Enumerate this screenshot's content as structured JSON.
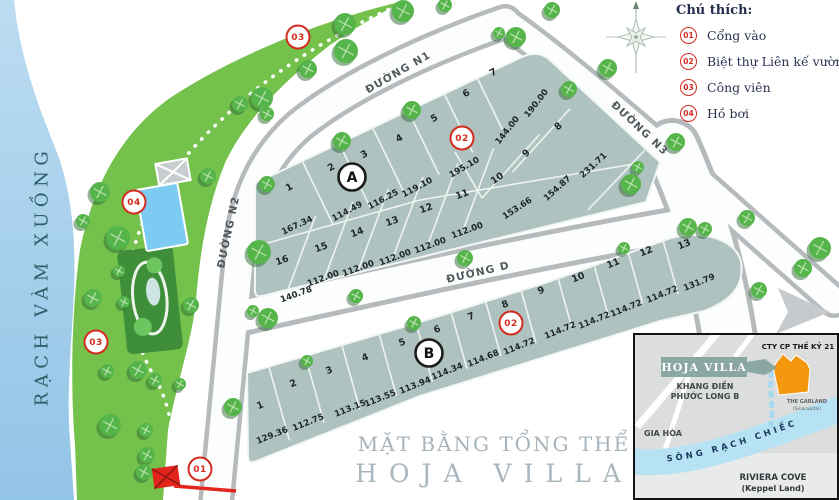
{
  "title": {
    "line1": "MẶT BẰNG TỔNG THỂ",
    "line2": "HOJA VILLA"
  },
  "legend": {
    "heading": "Chú thích:",
    "items": [
      {
        "num": "01",
        "label": "Cổng vào"
      },
      {
        "num": "02",
        "label": "Biệt thự Liên kế vườn"
      },
      {
        "num": "03",
        "label": "Công viên"
      },
      {
        "num": "04",
        "label": "Hồ bơi"
      }
    ]
  },
  "river_label": "RẠCH VÀM XUỒNG",
  "roads": [
    {
      "name": "ĐƯỜNG N1"
    },
    {
      "name": "ĐƯỜNG N2"
    },
    {
      "name": "ĐƯỜNG N3"
    },
    {
      "name": "ĐƯỜNG D"
    }
  ],
  "blocks": [
    {
      "name": "A",
      "marker": {
        "x": 352,
        "y": 177
      },
      "lots": [
        {
          "n": "1",
          "x": 289,
          "y": 187,
          "a": -29
        },
        {
          "n": "2",
          "x": 331,
          "y": 167,
          "a": -29
        },
        {
          "n": "3",
          "x": 364,
          "y": 154,
          "a": -29
        },
        {
          "n": "4",
          "x": 399,
          "y": 138,
          "a": -29
        },
        {
          "n": "5",
          "x": 434,
          "y": 118,
          "a": -29
        },
        {
          "n": "6",
          "x": 466,
          "y": 93,
          "a": -29
        },
        {
          "n": "7",
          "x": 493,
          "y": 72,
          "a": -29
        },
        {
          "n": "8",
          "x": 558,
          "y": 126,
          "a": -42
        },
        {
          "n": "9",
          "x": 526,
          "y": 153,
          "a": -42
        },
        {
          "n": "10",
          "x": 497,
          "y": 178,
          "a": -35
        },
        {
          "n": "11",
          "x": 462,
          "y": 194,
          "a": -20
        },
        {
          "n": "12",
          "x": 426,
          "y": 208,
          "a": -20
        },
        {
          "n": "13",
          "x": 392,
          "y": 221,
          "a": -20
        },
        {
          "n": "14",
          "x": 357,
          "y": 232,
          "a": -20
        },
        {
          "n": "15",
          "x": 321,
          "y": 247,
          "a": -20
        },
        {
          "n": "16",
          "x": 282,
          "y": 260,
          "a": -20
        }
      ],
      "dims": [
        {
          "v": "167.34",
          "x": 297,
          "y": 225,
          "a": -25
        },
        {
          "v": "114.49",
          "x": 347,
          "y": 211,
          "a": -28
        },
        {
          "v": "116.25",
          "x": 383,
          "y": 199,
          "a": -28
        },
        {
          "v": "119.10",
          "x": 417,
          "y": 187,
          "a": -28
        },
        {
          "v": "195.10",
          "x": 464,
          "y": 167,
          "a": -30
        },
        {
          "v": "144.00",
          "x": 507,
          "y": 130,
          "a": -52
        },
        {
          "v": "190.00",
          "x": 536,
          "y": 103,
          "a": -52
        },
        {
          "v": "231.71",
          "x": 593,
          "y": 165,
          "a": -42
        },
        {
          "v": "154.87",
          "x": 557,
          "y": 188,
          "a": -42
        },
        {
          "v": "153.66",
          "x": 517,
          "y": 208,
          "a": -33
        },
        {
          "v": "112.00",
          "x": 467,
          "y": 230,
          "a": -20
        },
        {
          "v": "112.00",
          "x": 430,
          "y": 245,
          "a": -20
        },
        {
          "v": "112.00",
          "x": 395,
          "y": 257,
          "a": -20
        },
        {
          "v": "112.00",
          "x": 358,
          "y": 268,
          "a": -20
        },
        {
          "v": "112.00",
          "x": 323,
          "y": 278,
          "a": -20
        },
        {
          "v": "140.78",
          "x": 296,
          "y": 294,
          "a": -20
        }
      ]
    },
    {
      "name": "B",
      "marker": {
        "x": 429,
        "y": 353
      },
      "lots": [
        {
          "n": "1",
          "x": 260,
          "y": 405,
          "a": -22
        },
        {
          "n": "2",
          "x": 293,
          "y": 383,
          "a": -22
        },
        {
          "n": "3",
          "x": 329,
          "y": 370,
          "a": -22
        },
        {
          "n": "4",
          "x": 365,
          "y": 357,
          "a": -22
        },
        {
          "n": "5",
          "x": 402,
          "y": 342,
          "a": -22
        },
        {
          "n": "6",
          "x": 437,
          "y": 329,
          "a": -22
        },
        {
          "n": "7",
          "x": 471,
          "y": 316,
          "a": -22
        },
        {
          "n": "8",
          "x": 505,
          "y": 304,
          "a": -22
        },
        {
          "n": "9",
          "x": 541,
          "y": 290,
          "a": -22
        },
        {
          "n": "10",
          "x": 578,
          "y": 277,
          "a": -22
        },
        {
          "n": "11",
          "x": 613,
          "y": 263,
          "a": -22
        },
        {
          "n": "12",
          "x": 646,
          "y": 251,
          "a": -22
        },
        {
          "n": "13",
          "x": 684,
          "y": 244,
          "a": -22
        }
      ],
      "dims": [
        {
          "v": "129.36",
          "x": 272,
          "y": 435,
          "a": -22
        },
        {
          "v": "112.75",
          "x": 308,
          "y": 422,
          "a": -22
        },
        {
          "v": "113.15",
          "x": 350,
          "y": 408,
          "a": -22
        },
        {
          "v": "113.55",
          "x": 380,
          "y": 398,
          "a": -22
        },
        {
          "v": "113.94",
          "x": 415,
          "y": 385,
          "a": -22
        },
        {
          "v": "114.34",
          "x": 447,
          "y": 371,
          "a": -22
        },
        {
          "v": "114.68",
          "x": 483,
          "y": 358,
          "a": -22
        },
        {
          "v": "114.72",
          "x": 519,
          "y": 346,
          "a": -22
        },
        {
          "v": "114.72",
          "x": 560,
          "y": 330,
          "a": -22
        },
        {
          "v": "114.72",
          "x": 594,
          "y": 320,
          "a": -22
        },
        {
          "v": "114.72",
          "x": 626,
          "y": 308,
          "a": -22
        },
        {
          "v": "114.72",
          "x": 662,
          "y": 294,
          "a": -22
        },
        {
          "v": "131.79",
          "x": 699,
          "y": 282,
          "a": -22
        }
      ]
    }
  ],
  "poi_markers": [
    {
      "n": "03",
      "x": 298,
      "y": 37
    },
    {
      "n": "04",
      "x": 134,
      "y": 202
    },
    {
      "n": "03",
      "x": 96,
      "y": 342
    },
    {
      "n": "01",
      "x": 200,
      "y": 469
    },
    {
      "n": "02",
      "x": 462,
      "y": 138
    },
    {
      "n": "02",
      "x": 511,
      "y": 323
    }
  ],
  "inset": {
    "labels": {
      "company": "CTY CP THẾ KỶ 21",
      "project": "HOJA VILLA",
      "area1": "KHANG ĐIỀN",
      "area2": "PHƯỚC LONG B",
      "garland1": "THE GARLAND",
      "garland2": "(Sinacapital)",
      "giahoa": "GIA HÒA",
      "river": "SÔNG RẠCH CHIẾC",
      "riviera1": "RIVIERA COVE",
      "riviera2": "(Keppel Land)"
    }
  },
  "colors": {
    "accent_red": "#d42b1f",
    "park_green": "#74c24c",
    "lot_fill": "#aec3bf",
    "river_blue": "#a9d2ee",
    "pool_blue": "#7dcbf2",
    "site_orange": "#f2970e"
  }
}
